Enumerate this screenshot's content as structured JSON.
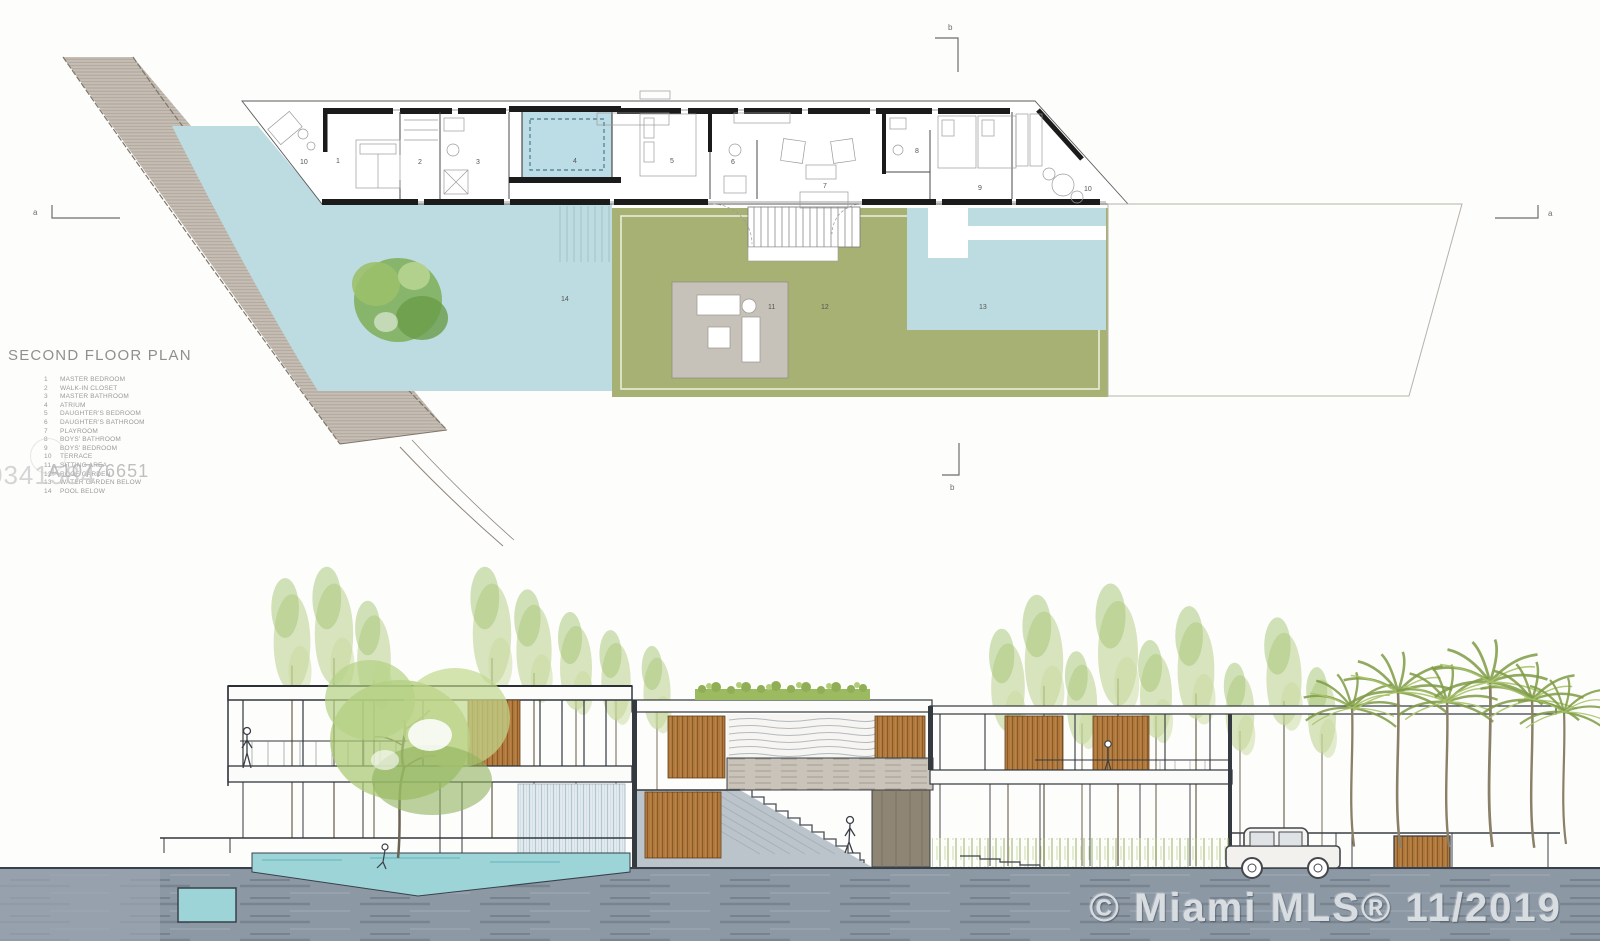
{
  "plan": {
    "title": "SECOND FLOOR PLAN",
    "legend": {
      "items": [
        {
          "num": "1",
          "label": "MASTER BEDROOM"
        },
        {
          "num": "2",
          "label": "WALK-IN CLOSET"
        },
        {
          "num": "3",
          "label": "MASTER BATHROOM"
        },
        {
          "num": "4",
          "label": "ATRIUM"
        },
        {
          "num": "5",
          "label": "DAUGHTER'S BEDROOM"
        },
        {
          "num": "6",
          "label": "DAUGHTER'S BATHROOM"
        },
        {
          "num": "7",
          "label": "PLAYROOM"
        },
        {
          "num": "8",
          "label": "BOYS' BATHROOM"
        },
        {
          "num": "9",
          "label": "BOYS' BEDROOM"
        },
        {
          "num": "10",
          "label": "TERRACE"
        },
        {
          "num": "11",
          "label": "SITTING AREA"
        },
        {
          "num": "12",
          "label": "ROOF GARDEN"
        },
        {
          "num": "13",
          "label": "WATER GARDEN BELOW"
        },
        {
          "num": "14",
          "label": "POOL BELOW"
        }
      ]
    },
    "room_labels": [
      {
        "n": "10"
      },
      {
        "n": "1"
      },
      {
        "n": "2"
      },
      {
        "n": "3"
      },
      {
        "n": "4"
      },
      {
        "n": "5"
      },
      {
        "n": "6"
      },
      {
        "n": "7"
      },
      {
        "n": "8"
      },
      {
        "n": "9"
      },
      {
        "n": "10"
      },
      {
        "n": "11"
      },
      {
        "n": "12"
      },
      {
        "n": "13"
      },
      {
        "n": "14"
      }
    ],
    "section_markers": {
      "left": "a",
      "right": "a",
      "top": "b",
      "bottom": "b"
    }
  },
  "watermarks": {
    "mls_id": "A10776651",
    "partial_id": "0341584",
    "footer": "© Miami MLS® 11/2019"
  },
  "colors": {
    "pool_blue": "#bddce1",
    "roof_green": "#a6b173",
    "deck_gray": "#c6c2ba",
    "road_gray": "#c6beb4",
    "wood_brown": "#b0783c",
    "ground_slate": "#8d98a5",
    "water_teal": "#9cd4d8",
    "line_dark": "#3a3f45"
  }
}
